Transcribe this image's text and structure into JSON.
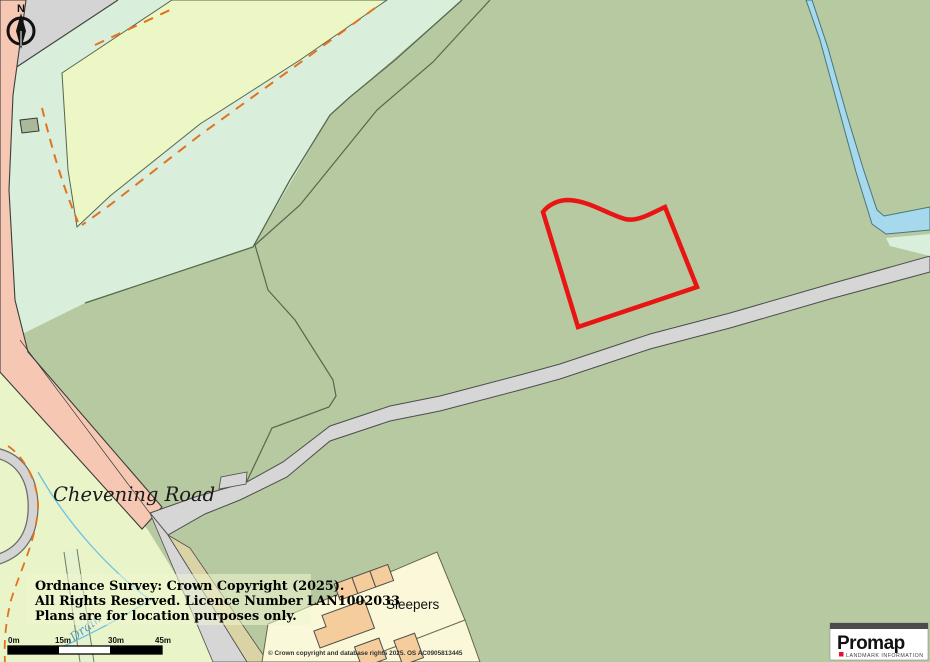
{
  "map": {
    "north_indicator": "N",
    "labels": {
      "road_name": "Chevening Road",
      "property_name": "Sleepers",
      "drain_label": "Drain"
    },
    "copyright_notice": {
      "line1": "Ordnance Survey: Crown Copyright (2025).",
      "line2": "All Rights Reserved. Licence Number LAN1002033",
      "line3": "Plans are for location purposes only."
    },
    "os_attribution": "© Crown copyright and database rights 2025. OS AC0905813445",
    "scale_bar": {
      "ticks": [
        "0m",
        "15m",
        "30m",
        "45m"
      ]
    },
    "branding": {
      "name": "Promap",
      "tagline": "LANDMARK INFORMATION"
    },
    "colors": {
      "field_sage": "#b6c9a0",
      "field_mint": "#d9efdc",
      "field_yellow": "#edf6c5",
      "field_yellow_left": "#e9f4c8",
      "road_grey": "#d6d6d6",
      "road_pink": "#f6c8b4",
      "track_khaki": "#d9d3a5",
      "parcel_cream": "#faf8d8",
      "building_tan": "#f5cd9c",
      "water_blue": "#a6d9ee",
      "plot_outline_red": "#e91414",
      "dash_orange": "#e2731e",
      "brand_red": "#e8112d"
    }
  }
}
